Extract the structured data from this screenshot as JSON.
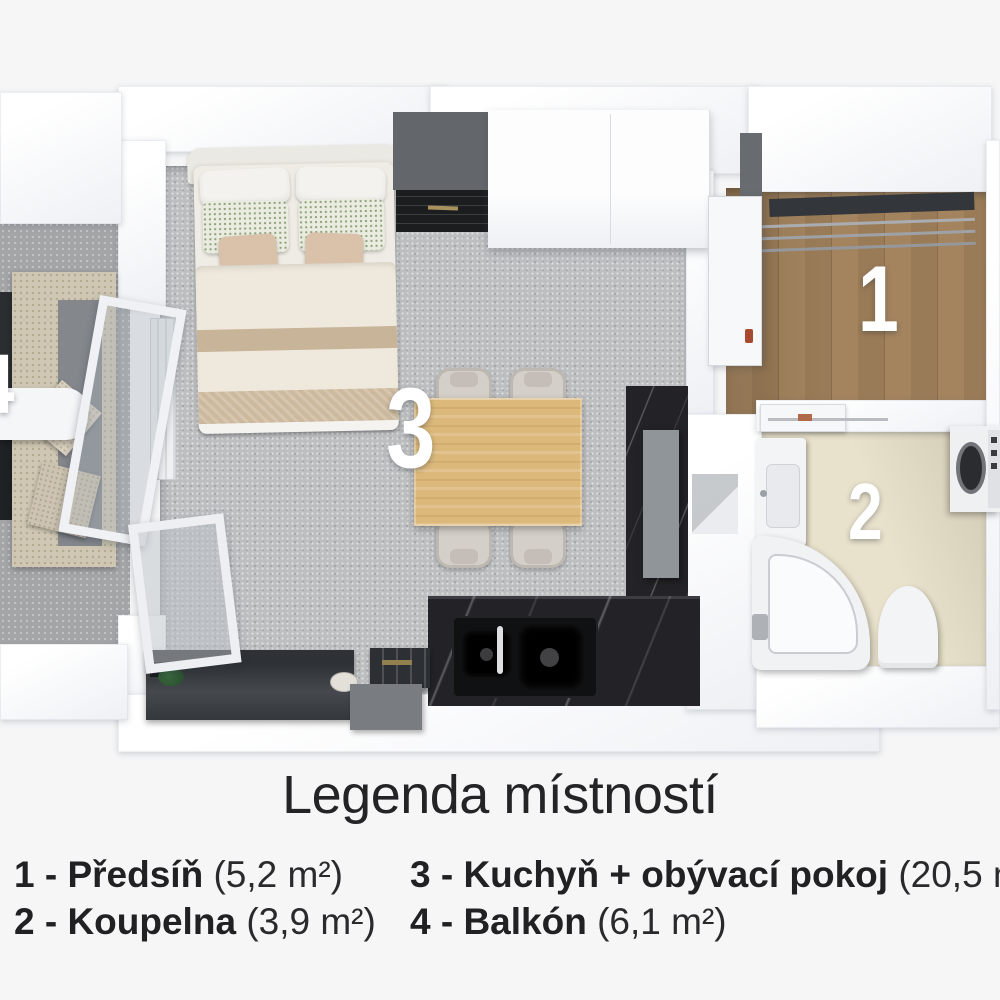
{
  "page": {
    "background": "#f6f6f7"
  },
  "plan": {
    "labels": {
      "hallway": "1",
      "bathroom": "2",
      "living_kitchen": "3",
      "balcony": "4"
    },
    "colors": {
      "carpet": "#bcbec0",
      "hallway_wood": "#9a7c5a",
      "bathroom_floor": "#e8e1cb",
      "kitchen_marble": "#232327",
      "table_wood": "#dcb87a",
      "room_number_text": "#ffffff"
    }
  },
  "legend": {
    "title": "Legenda místností",
    "items": [
      {
        "label": "1 - Předsíň",
        "area": "(5,2 m²)"
      },
      {
        "label": "2 - Koupelna",
        "area": "(3,9 m²)"
      },
      {
        "label": "3 - Kuchyň + obývací pokoj",
        "area": "(20,5 m²)"
      },
      {
        "label": "4 - Balkón",
        "area": "(6,1 m²)"
      }
    ]
  }
}
